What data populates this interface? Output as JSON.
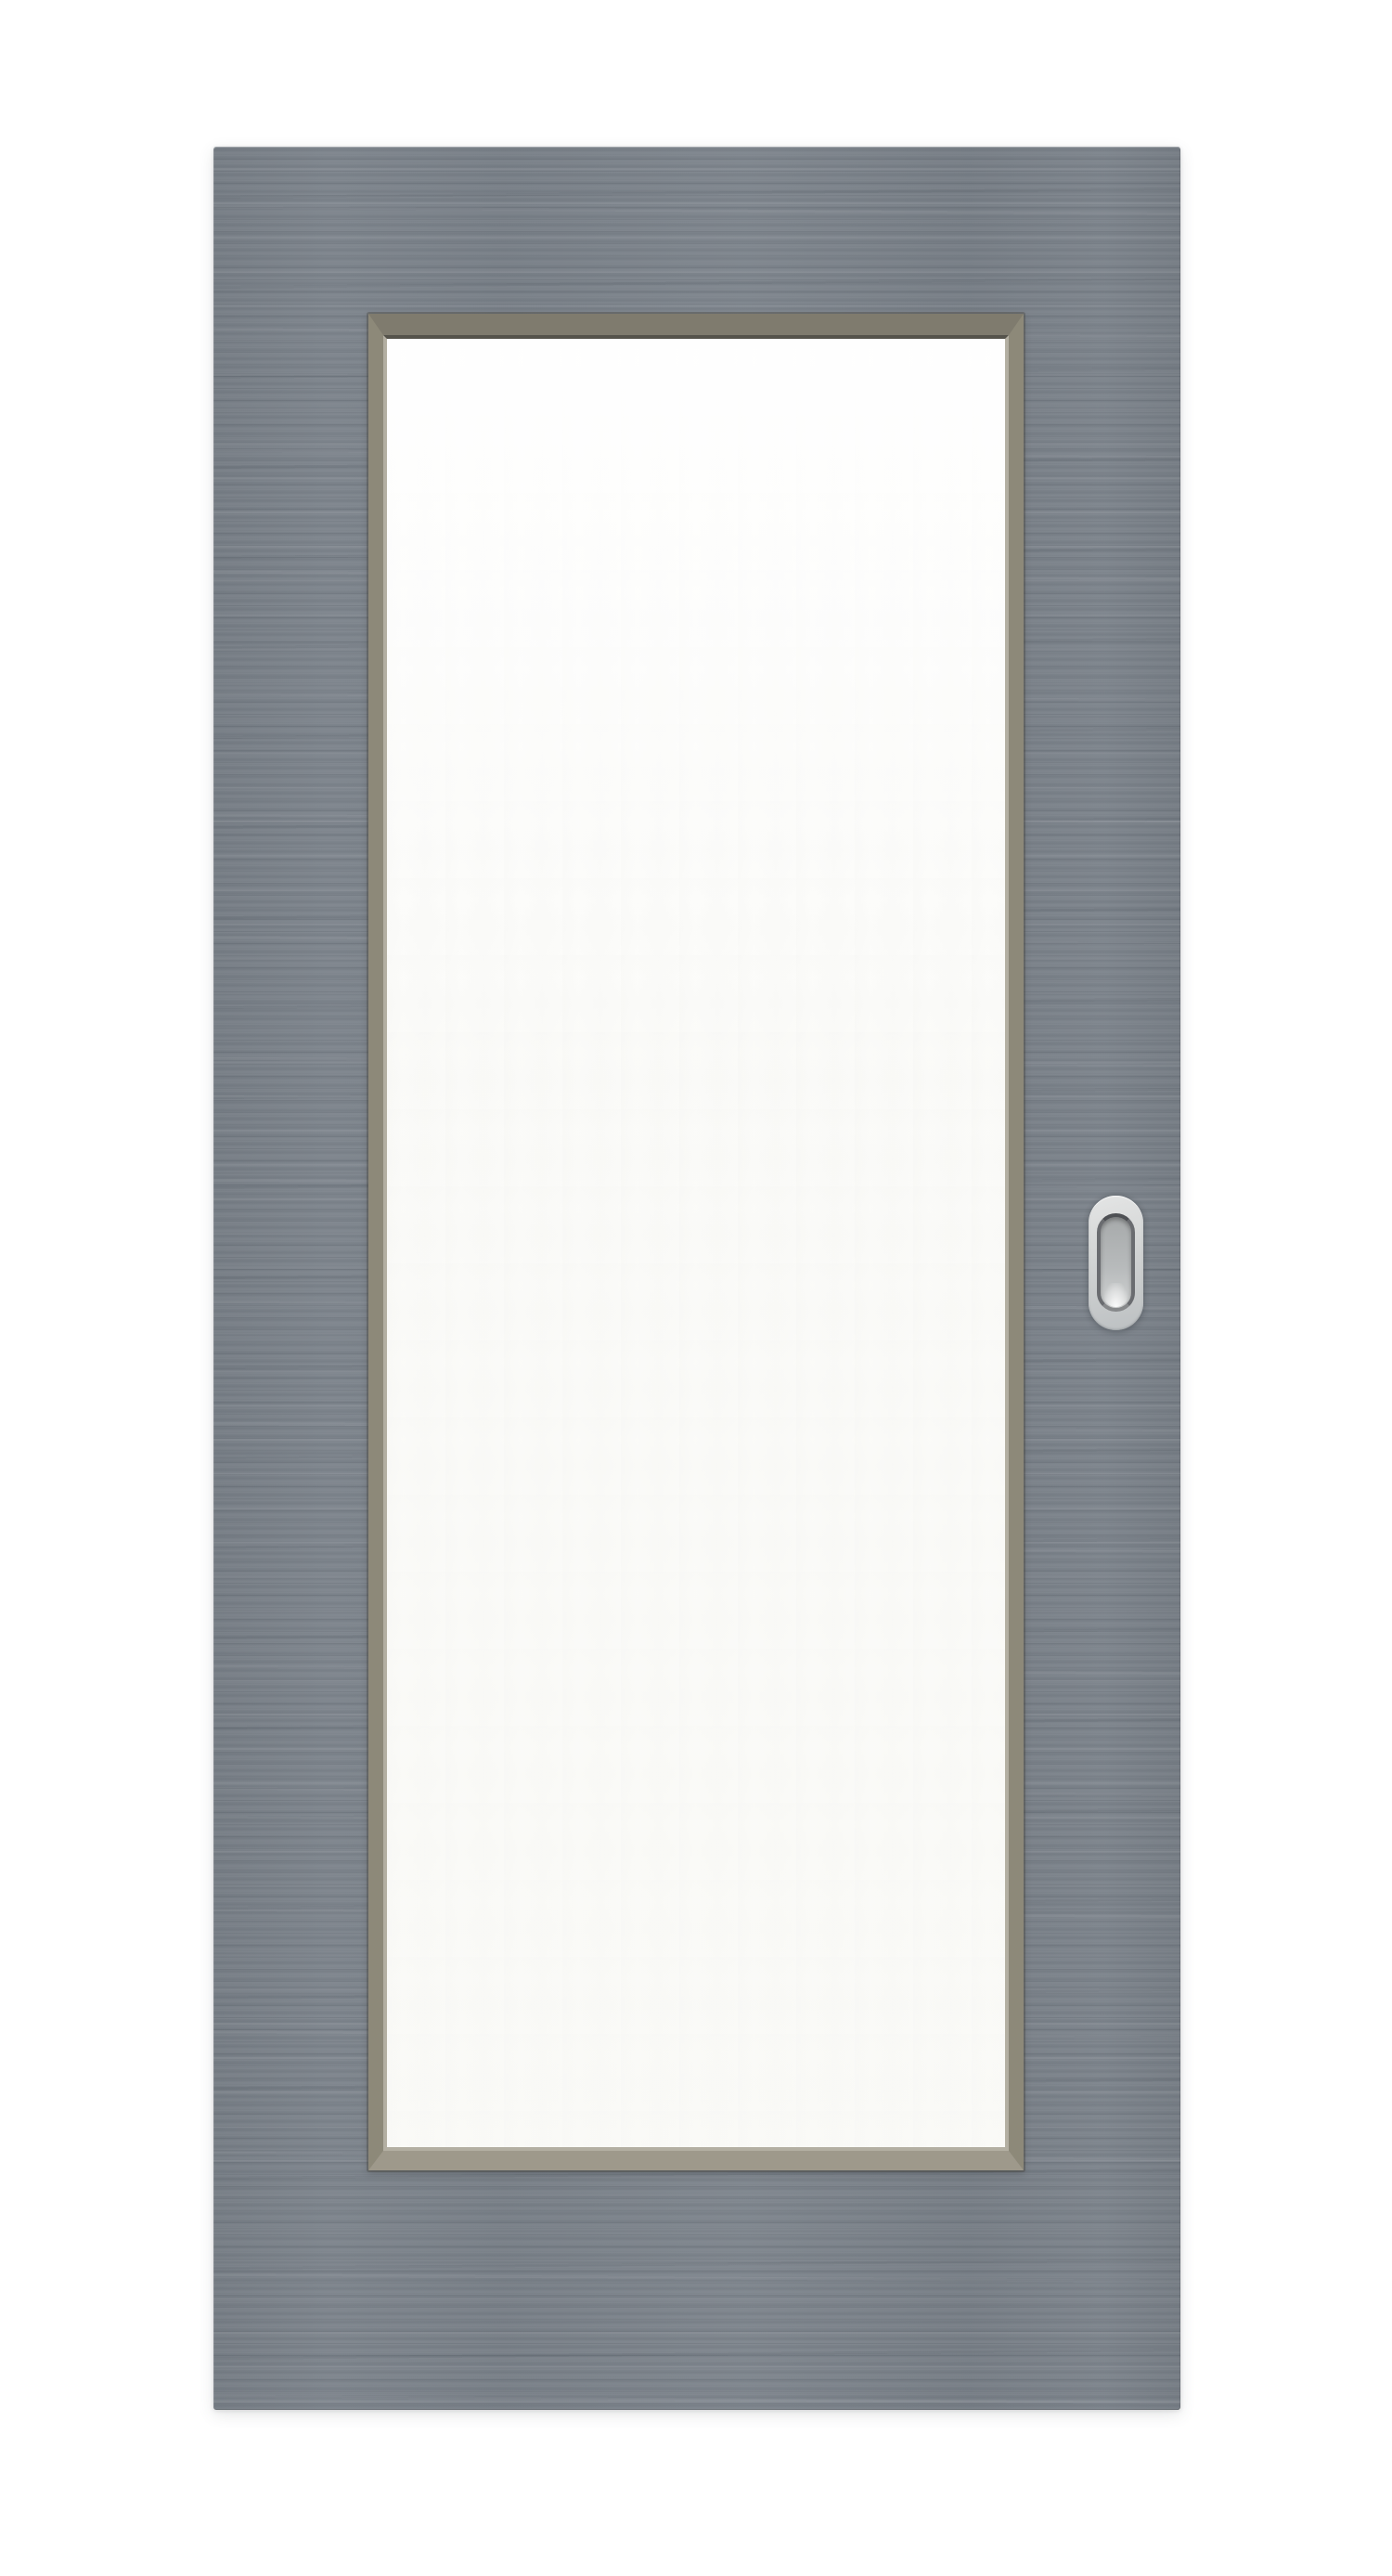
{
  "scene": {
    "name": "interior-sliding-door-product-photo",
    "description": "Front view product photograph of a gray sliding interior door on a plain white background",
    "elements": {
      "door_slab": "gray door slab with fine horizontal woodgrain texture",
      "glass_frame": "taupe beveled glazing-bead frame with mitered corners",
      "glass_panel": "large full-height frosted white glass insert",
      "handle": "oval recessed flush-pull handle, brushed silver, mid-height near right edge"
    },
    "visible_text": []
  },
  "colors": {
    "background": "#ffffff",
    "door-base": "#7b828a",
    "door-grain-dark": "#6e757c",
    "door-grain-light": "#868d93",
    "frame-top": "#7f7b6e",
    "frame-side": "#8d8979",
    "frame-bottom": "#9e998b",
    "frame-dark-line": "#55534b",
    "frame-light-lip": "#b3afa2",
    "glass": "#fcfcfa",
    "handle-plate-light": "#e4e5e5",
    "handle-plate": "#d2d4d4",
    "handle-plate-dark": "#bcc0c2",
    "handle-ring-dark": "#4e5054",
    "handle-ring": "#6a6c70",
    "handle-ring-light": "#86888a",
    "handle-recess-top": "#a7aaab",
    "handle-recess-mid": "#b7babb",
    "handle-recess-bottom": "#d0d2d2"
  }
}
